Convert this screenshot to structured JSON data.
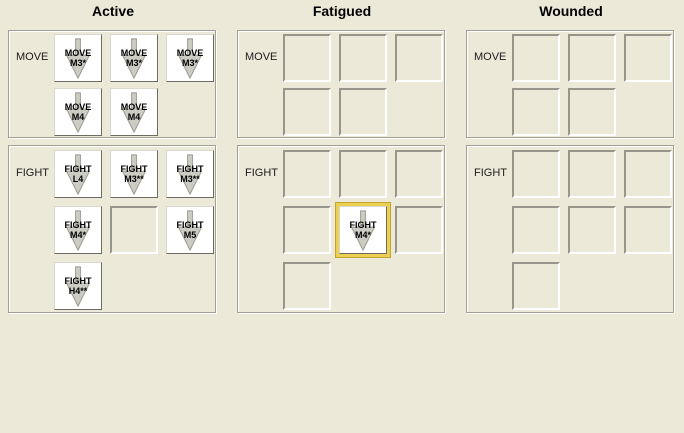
{
  "colors": {
    "background": "#ece9d8",
    "chit_background": "#ffffff",
    "chit_arrow_gray": "#cdccc4",
    "slot_border_dark": "#98968a",
    "box_border_gray": "#a3a093",
    "highlight_gold": "#ecd052",
    "highlight_gold_outline": "#c2a52f",
    "text": "#000000"
  },
  "panels": [
    {
      "title": "Active",
      "sections": [
        {
          "label": "MOVE",
          "rows": [
            [
              {
                "type": "chit",
                "line1": "MOVE",
                "line2": "M3*"
              },
              {
                "type": "chit",
                "line1": "MOVE",
                "line2": "M3*"
              },
              {
                "type": "chit",
                "line1": "MOVE",
                "line2": "M3*"
              }
            ],
            [
              {
                "type": "chit",
                "line1": "MOVE",
                "line2": "M4"
              },
              {
                "type": "chit",
                "line1": "MOVE",
                "line2": "M4"
              },
              {
                "type": "none"
              }
            ]
          ]
        },
        {
          "label": "FIGHT",
          "rows": [
            [
              {
                "type": "chit",
                "line1": "FIGHT",
                "line2": "L4"
              },
              {
                "type": "chit",
                "line1": "FIGHT",
                "line2": "M3**"
              },
              {
                "type": "chit",
                "line1": "FIGHT",
                "line2": "M3**"
              }
            ],
            [
              {
                "type": "chit",
                "line1": "FIGHT",
                "line2": "M4*"
              },
              {
                "type": "slot"
              },
              {
                "type": "chit",
                "line1": "FIGHT",
                "line2": "M5"
              }
            ],
            [
              {
                "type": "chit",
                "line1": "FIGHT",
                "line2": "H4**"
              },
              {
                "type": "none"
              },
              {
                "type": "none"
              }
            ]
          ]
        }
      ]
    },
    {
      "title": "Fatigued",
      "sections": [
        {
          "label": "MOVE",
          "rows": [
            [
              {
                "type": "slot"
              },
              {
                "type": "slot"
              },
              {
                "type": "slot"
              }
            ],
            [
              {
                "type": "slot"
              },
              {
                "type": "slot"
              },
              {
                "type": "none"
              }
            ]
          ]
        },
        {
          "label": "FIGHT",
          "rows": [
            [
              {
                "type": "slot"
              },
              {
                "type": "slot"
              },
              {
                "type": "slot"
              }
            ],
            [
              {
                "type": "slot"
              },
              {
                "type": "chit",
                "line1": "FIGHT",
                "line2": "M4*",
                "highlighted": true
              },
              {
                "type": "slot"
              }
            ],
            [
              {
                "type": "slot"
              },
              {
                "type": "none"
              },
              {
                "type": "none"
              }
            ]
          ]
        }
      ]
    },
    {
      "title": "Wounded",
      "sections": [
        {
          "label": "MOVE",
          "rows": [
            [
              {
                "type": "slot"
              },
              {
                "type": "slot"
              },
              {
                "type": "slot"
              }
            ],
            [
              {
                "type": "slot"
              },
              {
                "type": "slot"
              },
              {
                "type": "none"
              }
            ]
          ]
        },
        {
          "label": "FIGHT",
          "rows": [
            [
              {
                "type": "slot"
              },
              {
                "type": "slot"
              },
              {
                "type": "slot"
              }
            ],
            [
              {
                "type": "slot"
              },
              {
                "type": "slot"
              },
              {
                "type": "slot"
              }
            ],
            [
              {
                "type": "slot"
              },
              {
                "type": "none"
              },
              {
                "type": "none"
              }
            ]
          ]
        }
      ]
    }
  ]
}
